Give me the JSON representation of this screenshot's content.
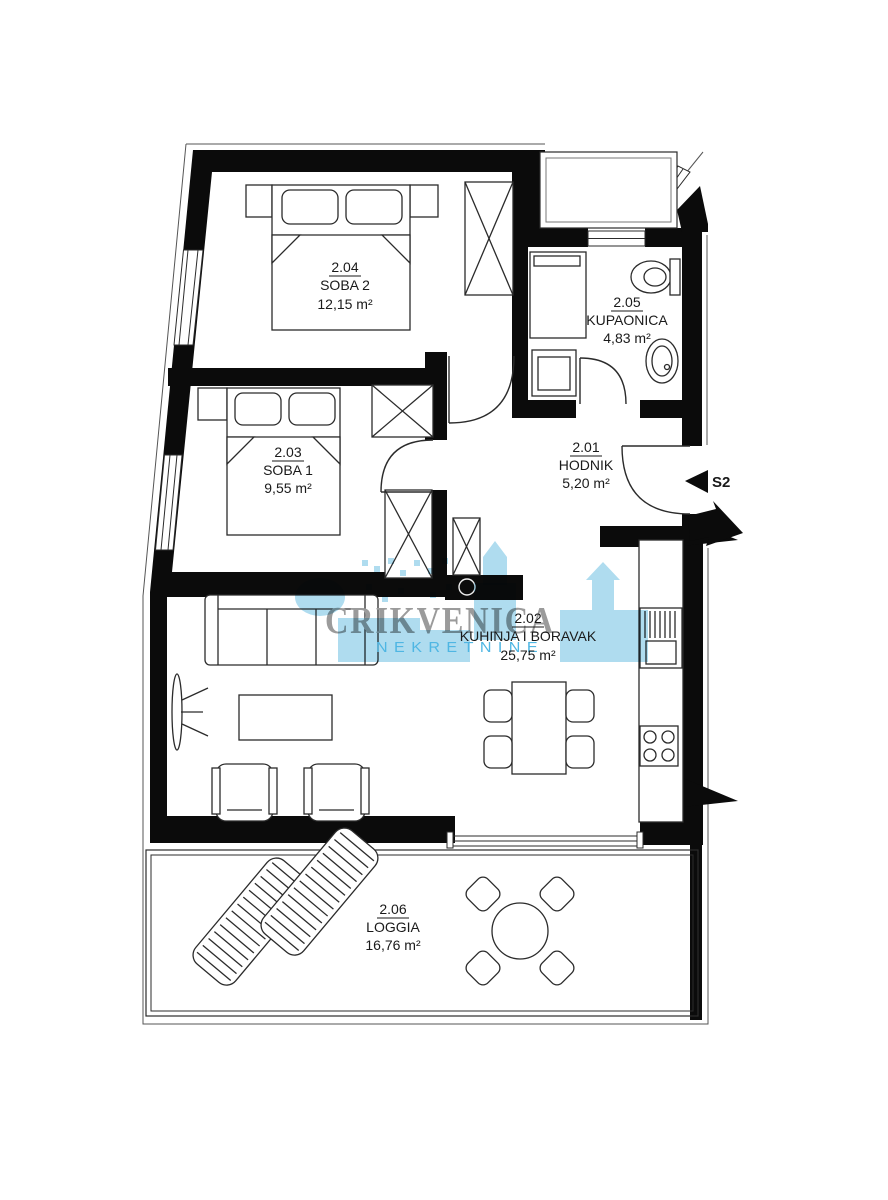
{
  "plan": {
    "entry_marker": "S2",
    "watermark": {
      "name": "CRIKVENICA",
      "subtitle": "NEKRETNINE"
    },
    "colors": {
      "wall": "#0b0b0b",
      "watermark_blue": "#a6d9ee",
      "watermark_gray": "#9b9b9b",
      "watermark_subtitle_blue": "#4fb6e3"
    },
    "rooms": [
      {
        "code": "2.04",
        "name": "SOBA 2",
        "area": "12,15 m²"
      },
      {
        "code": "2.05",
        "name": "KUPAONICA",
        "area": "4,83 m²"
      },
      {
        "code": "2.03",
        "name": "SOBA 1",
        "area": "9,55 m²"
      },
      {
        "code": "2.01",
        "name": "HODNIK",
        "area": "5,20 m²"
      },
      {
        "code": "2.02",
        "name": "KUHINJA I BORAVAK",
        "area": "25,75 m²"
      },
      {
        "code": "2.06",
        "name": "LOGGIA",
        "area": "16,76 m²"
      }
    ]
  }
}
